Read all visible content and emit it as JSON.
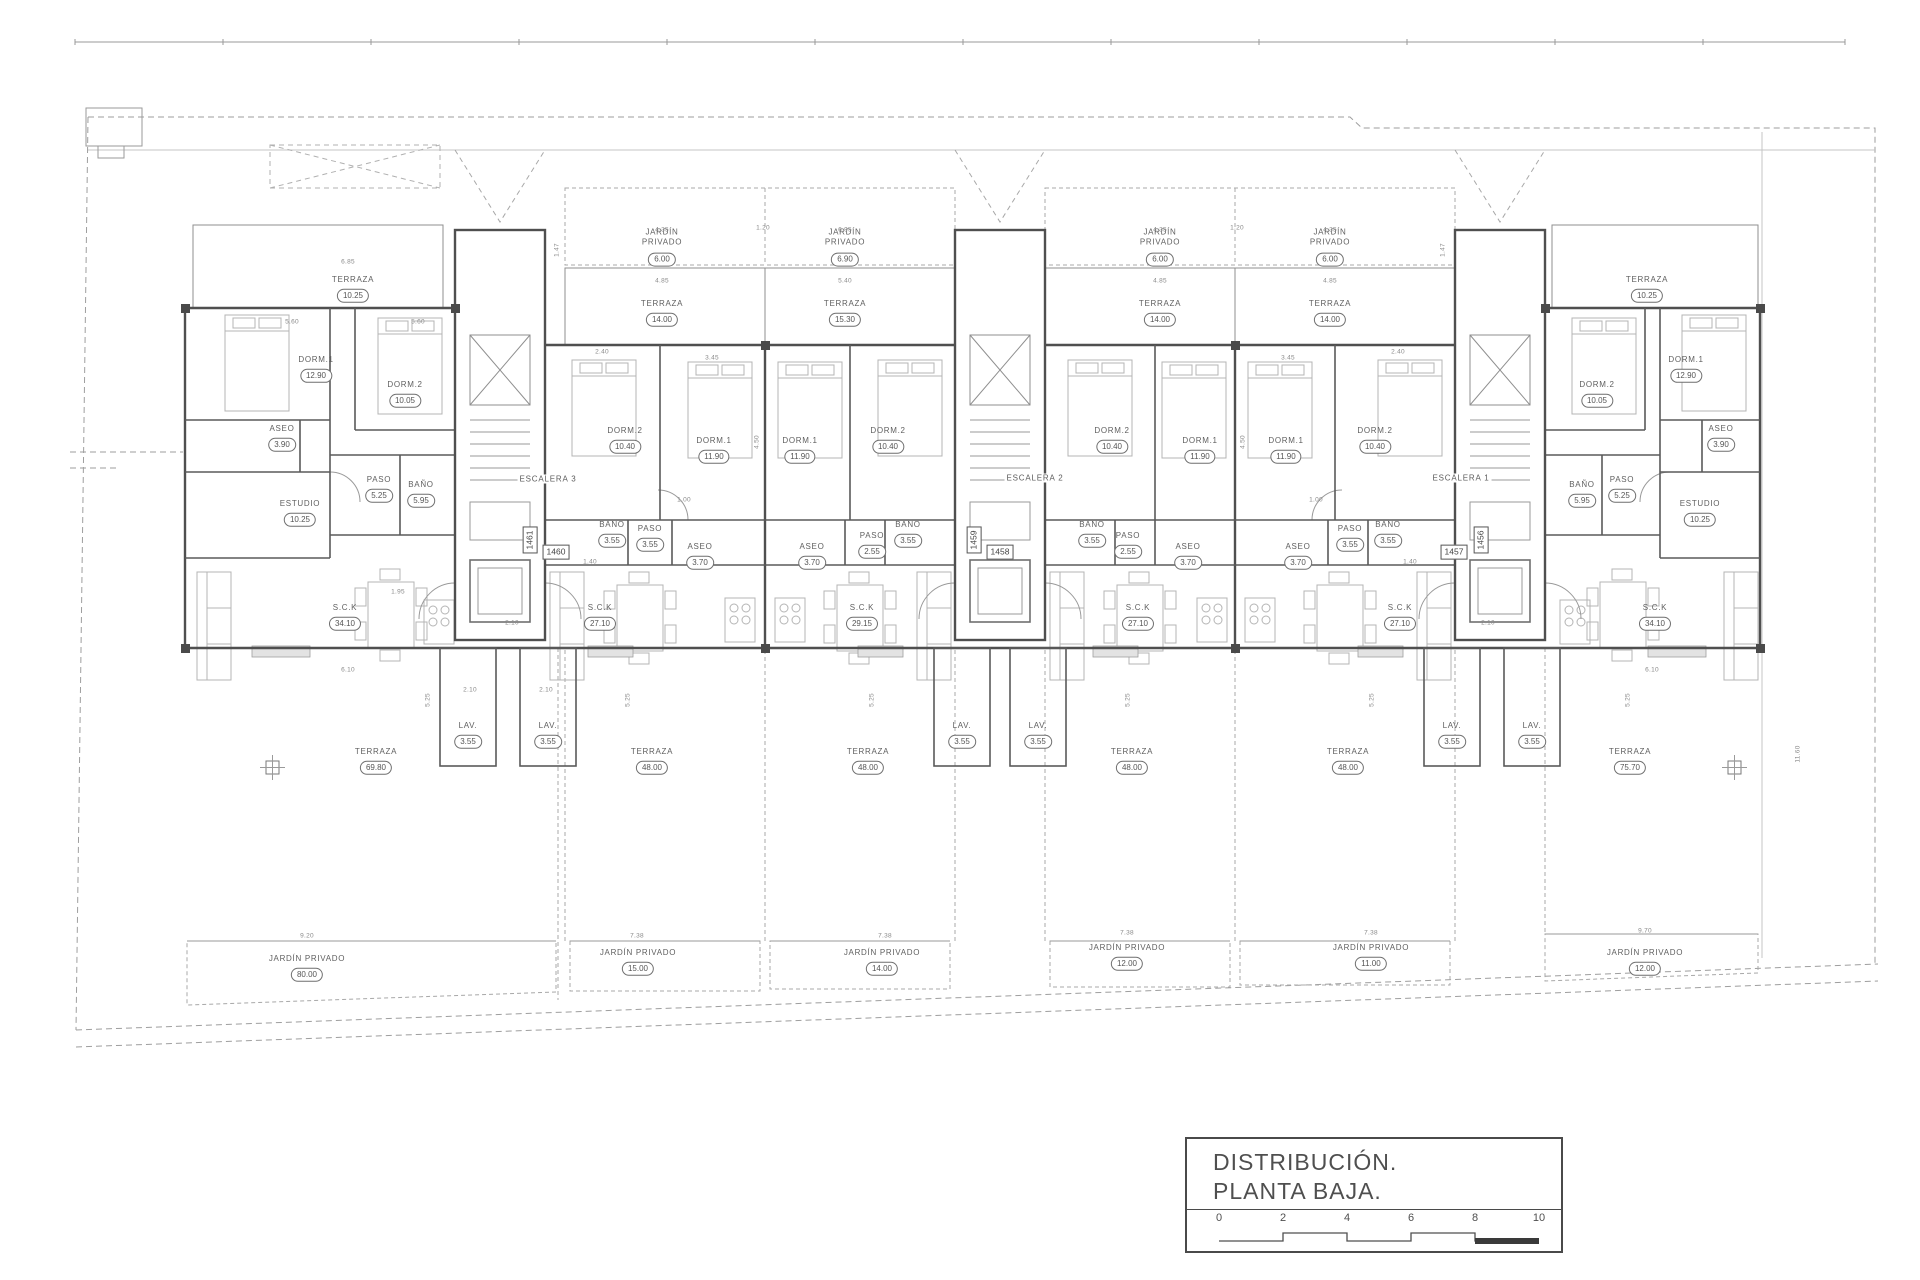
{
  "colors": {
    "wall": "#4f4f4f",
    "thin_line": "#8f8f8f",
    "dashed_line": "#9e9e9e",
    "furniture": "#b4b4b4",
    "text": "#5a5a5a",
    "background": "#ffffff"
  },
  "title_block": {
    "line1": "DISTRIBUCIÓN.",
    "line2": "PLANTA BAJA.",
    "scale_ticks": [
      "0",
      "2",
      "4",
      "6",
      "8",
      "10"
    ]
  },
  "plan": {
    "units": [
      {
        "plot": "1461",
        "rooms": [
          {
            "n": "TERRAZA",
            "v": "10.25",
            "x": 353,
            "y": 289
          },
          {
            "n": "DORM.1",
            "v": "12.90",
            "x": 316,
            "y": 369
          },
          {
            "n": "DORM.2",
            "v": "10.05",
            "x": 405,
            "y": 394
          },
          {
            "n": "ASEO",
            "v": "3.90",
            "x": 282,
            "y": 438
          },
          {
            "n": "PASO",
            "v": "5.25",
            "x": 379,
            "y": 489
          },
          {
            "n": "BAÑO",
            "v": "5.95",
            "x": 421,
            "y": 494
          },
          {
            "n": "ESTUDIO",
            "v": "10.25",
            "x": 300,
            "y": 513
          },
          {
            "n": "S.C.K",
            "v": "34.10",
            "x": 345,
            "y": 617
          },
          {
            "n": "LAV.",
            "v": "3.55",
            "x": 468,
            "y": 735
          },
          {
            "n": "TERRAZA",
            "v": "69.80",
            "x": 376,
            "y": 761
          },
          {
            "n": "JARDÍN PRIVADO",
            "v": "80.00",
            "x": 307,
            "y": 968
          }
        ]
      },
      {
        "plot": "1460",
        "rooms": [
          {
            "n": "JARDÍN PRIVADO",
            "v": "6.00",
            "x": 662,
            "y": 247,
            "stack": true
          },
          {
            "n": "TERRAZA",
            "v": "14.00",
            "x": 662,
            "y": 313
          },
          {
            "n": "DORM.2",
            "v": "10.40",
            "x": 625,
            "y": 440
          },
          {
            "n": "DORM.1",
            "v": "11.90",
            "x": 714,
            "y": 450
          },
          {
            "n": "BAÑO",
            "v": "3.55",
            "x": 612,
            "y": 534
          },
          {
            "n": "PASO",
            "v": "3.55",
            "x": 650,
            "y": 538
          },
          {
            "n": "ASEO",
            "v": "3.70",
            "x": 700,
            "y": 556
          },
          {
            "n": "S.C.K",
            "v": "27.10",
            "x": 600,
            "y": 617
          },
          {
            "n": "LAV.",
            "v": "3.55",
            "x": 548,
            "y": 735
          },
          {
            "n": "TERRAZA",
            "v": "48.00",
            "x": 652,
            "y": 761
          },
          {
            "n": "JARDÍN PRIVADO",
            "v": "15.00",
            "x": 638,
            "y": 962
          }
        ]
      },
      {
        "plot": "1459",
        "rooms": [
          {
            "n": "JARDÍN PRIVADO",
            "v": "6.90",
            "x": 845,
            "y": 247,
            "stack": true
          },
          {
            "n": "TERRAZA",
            "v": "15.30",
            "x": 845,
            "y": 313
          },
          {
            "n": "DORM.1",
            "v": "11.90",
            "x": 800,
            "y": 450
          },
          {
            "n": "DORM.2",
            "v": "10.40",
            "x": 888,
            "y": 440
          },
          {
            "n": "ASEO",
            "v": "3.70",
            "x": 812,
            "y": 556
          },
          {
            "n": "PASO",
            "v": "2.55",
            "x": 872,
            "y": 545
          },
          {
            "n": "BAÑO",
            "v": "3.55",
            "x": 908,
            "y": 534
          },
          {
            "n": "S.C.K",
            "v": "29.15",
            "x": 862,
            "y": 617
          },
          {
            "n": "LAV.",
            "v": "3.55",
            "x": 962,
            "y": 735
          },
          {
            "n": "TERRAZA",
            "v": "48.00",
            "x": 868,
            "y": 761
          },
          {
            "n": "JARDÍN PRIVADO",
            "v": "14.00",
            "x": 882,
            "y": 962
          }
        ]
      },
      {
        "plot": "1458",
        "rooms": [
          {
            "n": "JARDÍN PRIVADO",
            "v": "6.00",
            "x": 1160,
            "y": 247,
            "stack": true
          },
          {
            "n": "TERRAZA",
            "v": "14.00",
            "x": 1160,
            "y": 313
          },
          {
            "n": "DORM.2",
            "v": "10.40",
            "x": 1112,
            "y": 440
          },
          {
            "n": "DORM.1",
            "v": "11.90",
            "x": 1200,
            "y": 450
          },
          {
            "n": "BAÑO",
            "v": "3.55",
            "x": 1092,
            "y": 534
          },
          {
            "n": "PASO",
            "v": "2.55",
            "x": 1128,
            "y": 545
          },
          {
            "n": "ASEO",
            "v": "3.70",
            "x": 1188,
            "y": 556
          },
          {
            "n": "S.C.K",
            "v": "27.10",
            "x": 1138,
            "y": 617
          },
          {
            "n": "LAV.",
            "v": "3.55",
            "x": 1038,
            "y": 735
          },
          {
            "n": "TERRAZA",
            "v": "48.00",
            "x": 1132,
            "y": 761
          },
          {
            "n": "JARDÍN PRIVADO",
            "v": "12.00",
            "x": 1127,
            "y": 957
          }
        ]
      },
      {
        "plot": "1457",
        "rooms": [
          {
            "n": "JARDÍN PRIVADO",
            "v": "6.00",
            "x": 1330,
            "y": 247,
            "stack": true
          },
          {
            "n": "TERRAZA",
            "v": "14.00",
            "x": 1330,
            "y": 313
          },
          {
            "n": "DORM.1",
            "v": "11.90",
            "x": 1286,
            "y": 450
          },
          {
            "n": "DORM.2",
            "v": "10.40",
            "x": 1375,
            "y": 440
          },
          {
            "n": "ASEO",
            "v": "3.70",
            "x": 1298,
            "y": 556
          },
          {
            "n": "PASO",
            "v": "3.55",
            "x": 1350,
            "y": 538
          },
          {
            "n": "BAÑO",
            "v": "3.55",
            "x": 1388,
            "y": 534
          },
          {
            "n": "S.C.K",
            "v": "27.10",
            "x": 1400,
            "y": 617
          },
          {
            "n": "LAV.",
            "v": "3.55",
            "x": 1452,
            "y": 735
          },
          {
            "n": "TERRAZA",
            "v": "48.00",
            "x": 1348,
            "y": 761
          },
          {
            "n": "JARDÍN PRIVADO",
            "v": "11.00",
            "x": 1371,
            "y": 957
          }
        ]
      },
      {
        "plot": "1456",
        "rooms": [
          {
            "n": "TERRAZA",
            "v": "10.25",
            "x": 1647,
            "y": 289
          },
          {
            "n": "DORM.2",
            "v": "10.05",
            "x": 1597,
            "y": 394
          },
          {
            "n": "DORM.1",
            "v": "12.90",
            "x": 1686,
            "y": 369
          },
          {
            "n": "ASEO",
            "v": "3.90",
            "x": 1721,
            "y": 438
          },
          {
            "n": "BAÑO",
            "v": "5.95",
            "x": 1582,
            "y": 494
          },
          {
            "n": "PASO",
            "v": "5.25",
            "x": 1622,
            "y": 489
          },
          {
            "n": "ESTUDIO",
            "v": "10.25",
            "x": 1700,
            "y": 513
          },
          {
            "n": "S.C.K",
            "v": "34.10",
            "x": 1655,
            "y": 617
          },
          {
            "n": "LAV.",
            "v": "3.55",
            "x": 1532,
            "y": 735
          },
          {
            "n": "TERRAZA",
            "v": "75.70",
            "x": 1630,
            "y": 761
          },
          {
            "n": "JARDÍN PRIVADO",
            "v": "12.00",
            "x": 1645,
            "y": 962
          }
        ]
      }
    ],
    "stairs": [
      {
        "label": "ESCALERA 3",
        "x": 548,
        "y": 479
      },
      {
        "label": "ESCALERA 2",
        "x": 1035,
        "y": 478
      },
      {
        "label": "ESCALERA 1",
        "x": 1461,
        "y": 478
      }
    ],
    "plot_numbers": [
      {
        "label": "1461",
        "x": 530,
        "y": 540,
        "vertical": true
      },
      {
        "label": "1460",
        "x": 556,
        "y": 552
      },
      {
        "label": "1459",
        "x": 974,
        "y": 540,
        "vertical": true
      },
      {
        "label": "1458",
        "x": 1000,
        "y": 552
      },
      {
        "label": "1457",
        "x": 1454,
        "y": 552
      },
      {
        "label": "1456",
        "x": 1481,
        "y": 540,
        "vertical": true
      }
    ],
    "dimensions": [
      {
        "t": "6.85",
        "x": 348,
        "y": 262
      },
      {
        "t": "5.60",
        "x": 292,
        "y": 322
      },
      {
        "t": "5.60",
        "x": 418,
        "y": 322
      },
      {
        "t": "4.35",
        "x": 662,
        "y": 230
      },
      {
        "t": "4.85",
        "x": 662,
        "y": 281
      },
      {
        "t": "6.95",
        "x": 845,
        "y": 230
      },
      {
        "t": "5.40",
        "x": 845,
        "y": 281
      },
      {
        "t": "4.35",
        "x": 1160,
        "y": 230
      },
      {
        "t": "4.85",
        "x": 1160,
        "y": 281
      },
      {
        "t": "4.35",
        "x": 1330,
        "y": 230
      },
      {
        "t": "4.85",
        "x": 1330,
        "y": 281
      },
      {
        "t": "1.20",
        "x": 763,
        "y": 228
      },
      {
        "t": "1.20",
        "x": 1237,
        "y": 228
      },
      {
        "t": "1.47",
        "x": 557,
        "y": 250,
        "v": true
      },
      {
        "t": "1.47",
        "x": 1443,
        "y": 250,
        "v": true
      },
      {
        "t": "2.40",
        "x": 602,
        "y": 352
      },
      {
        "t": "3.45",
        "x": 712,
        "y": 358
      },
      {
        "t": "2.40",
        "x": 1398,
        "y": 352
      },
      {
        "t": "3.45",
        "x": 1288,
        "y": 358
      },
      {
        "t": "4.50",
        "x": 757,
        "y": 442,
        "v": true
      },
      {
        "t": "4.50",
        "x": 1243,
        "y": 442,
        "v": true
      },
      {
        "t": "1.00",
        "x": 684,
        "y": 500
      },
      {
        "t": "1.00",
        "x": 1316,
        "y": 500
      },
      {
        "t": "1.40",
        "x": 590,
        "y": 562
      },
      {
        "t": "1.40",
        "x": 1410,
        "y": 562
      },
      {
        "t": "2.10",
        "x": 512,
        "y": 623
      },
      {
        "t": "2.10",
        "x": 1488,
        "y": 623
      },
      {
        "t": "6.10",
        "x": 348,
        "y": 670
      },
      {
        "t": "6.10",
        "x": 1652,
        "y": 670
      },
      {
        "t": "1.95",
        "x": 398,
        "y": 592
      },
      {
        "t": "2.10",
        "x": 470,
        "y": 690
      },
      {
        "t": "2.10",
        "x": 546,
        "y": 690
      },
      {
        "t": "5.25",
        "x": 428,
        "y": 700,
        "v": true
      },
      {
        "t": "5.25",
        "x": 628,
        "y": 700,
        "v": true
      },
      {
        "t": "5.25",
        "x": 872,
        "y": 700,
        "v": true
      },
      {
        "t": "5.25",
        "x": 1128,
        "y": 700,
        "v": true
      },
      {
        "t": "5.25",
        "x": 1372,
        "y": 700,
        "v": true
      },
      {
        "t": "5.25",
        "x": 1628,
        "y": 700,
        "v": true
      },
      {
        "t": "9.20",
        "x": 307,
        "y": 936
      },
      {
        "t": "7.38",
        "x": 637,
        "y": 936
      },
      {
        "t": "7.38",
        "x": 885,
        "y": 936
      },
      {
        "t": "7.38",
        "x": 1127,
        "y": 933
      },
      {
        "t": "7.38",
        "x": 1371,
        "y": 933
      },
      {
        "t": "9.70",
        "x": 1645,
        "y": 931
      },
      {
        "t": "11.60",
        "x": 1798,
        "y": 754,
        "v": true
      }
    ]
  }
}
